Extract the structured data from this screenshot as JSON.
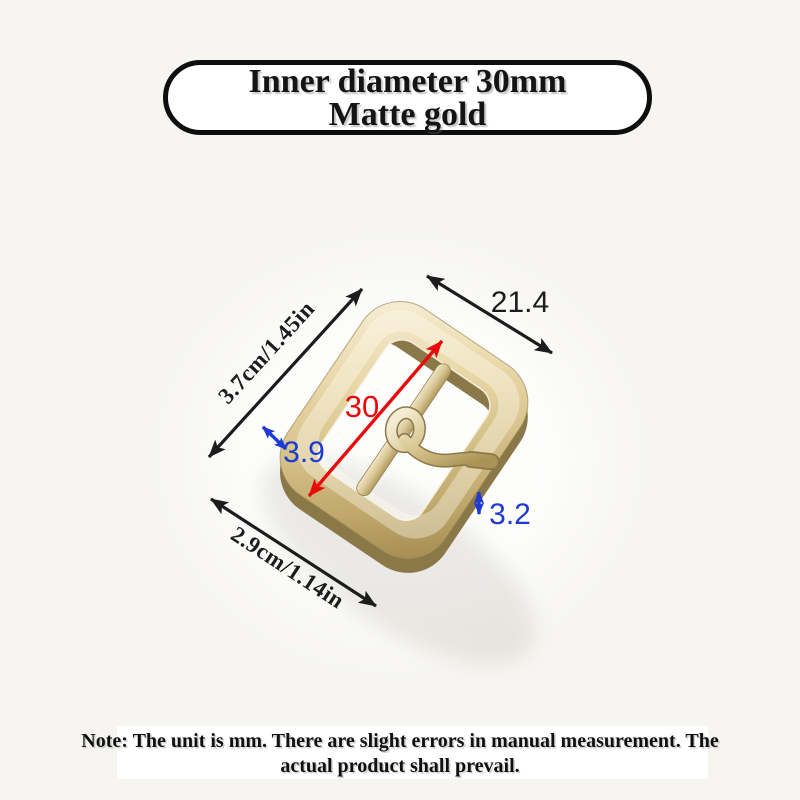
{
  "colors": {
    "background": "#f6f5f1",
    "dimension_black": "#1c1c1c",
    "dimension_red": "#e80b0b",
    "dimension_blue": "#1e3ad2",
    "gold_light": "#f6efd8",
    "gold_mid": "#d8c48d",
    "gold_dark": "#a78e52"
  },
  "title_box": {
    "line1": "Inner diameter 30mm",
    "line2": "Matte gold"
  },
  "product": {
    "name": "matte gold belt buckle with center bar and prong"
  },
  "dimensions": {
    "top_width": {
      "value": "21.4"
    },
    "left_side": {
      "value": "3.7cm/1.45in"
    },
    "inner_diameter": {
      "value": "30"
    },
    "frame_thickness": {
      "value": "3.9"
    },
    "prong_thickness": {
      "value": "3.2"
    },
    "bottom_width": {
      "value": "2.9cm/1.14in"
    }
  },
  "note": {
    "line1": "Note: The unit is mm. There are slight errors in manual measurement. The",
    "line2": "actual product shall prevail."
  }
}
